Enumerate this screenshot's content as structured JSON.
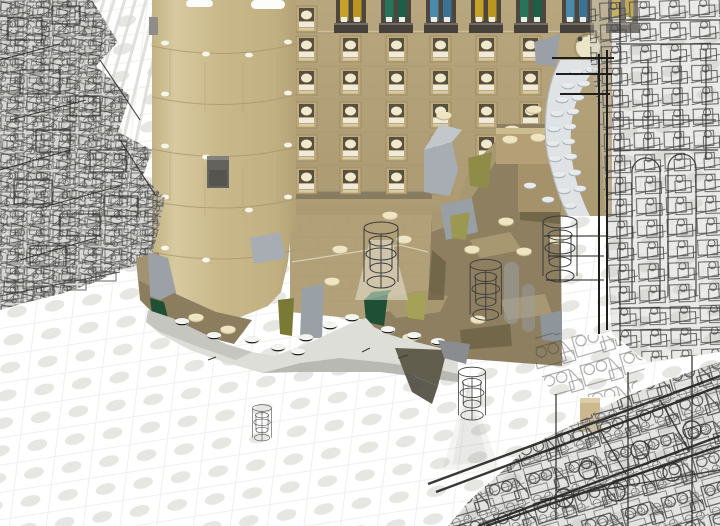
{
  "scene": {
    "title": "LEGO CAD viewport: tan castle tower rendered solid with surrounding structures shown as wireframe",
    "application": "brick-model-3d-viewport",
    "render_modes": [
      "solid",
      "wireframe"
    ],
    "background_color": "#ffffff"
  },
  "palette": {
    "wall_tan": "#b3a17a",
    "wall_tan_light": "#beac83",
    "tower_tan": "#c9b98b",
    "tower_tan_light": "#d8c9a0",
    "rock_dark_tan": "#8d7f60",
    "rock_light_top": "#a89872",
    "stud_cream": "#e6dab2",
    "slope_gray": "#9ba1a6",
    "slope_gray_light": "#b7bcc0",
    "stair_gray_white": "#dfe3e5",
    "olive_green": "#8f8c48",
    "olive_green_dark": "#7b7a34",
    "dark_green": "#1f4f35",
    "snow_white": "#deded8",
    "snow_side_gray": "#b9b9b3",
    "window_frame_dark": "#4e463c",
    "glass_yellow": "#c5a32a",
    "glass_green": "#27745a",
    "glass_blue": "#4b89ad",
    "round_window_face": "#ece4c6",
    "wireframe_line": "#3e3e3c",
    "baseplate_stud_gray": "#e6e6e3",
    "dark_plate_gray": "#5f5e58"
  },
  "model": {
    "stained_glass_row": {
      "count": 7,
      "colors": [
        "yellow",
        "green",
        "blue",
        "yellow",
        "green",
        "blue",
        "yellow"
      ]
    },
    "small_window_grid": {
      "columns": 6,
      "rows": 5,
      "extra_top_left_window": 1,
      "style": "recessed square with cream arch and white sill"
    },
    "round_window": {
      "count": 1,
      "style": "circular recessed cream medallion"
    },
    "sections": [
      "left-wireframe-structure",
      "round-tan-tower",
      "castle-window-wall",
      "rock-terrain-steps",
      "snow-white-base-plates",
      "gray-curved-stair",
      "wireframe-turrets",
      "right-wireframe-tower",
      "bottom-right-wireframe-mass",
      "studded-baseplate-ground"
    ]
  }
}
